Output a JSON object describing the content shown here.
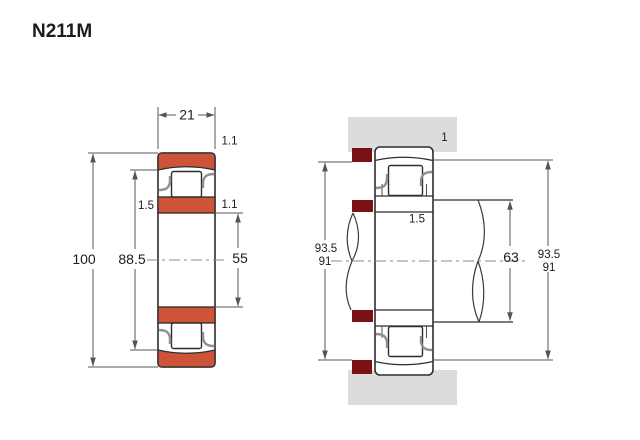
{
  "page": {
    "title": "N211M"
  },
  "colors": {
    "ring_fill": "#cd5438",
    "abutment_fill": "#7a1115",
    "housing_fill": "#dcdcdc"
  },
  "section_view": {
    "labels": {
      "width": "21",
      "outer_diameter": "100",
      "raceway_diameter": "88.5",
      "bore_diameter": "55",
      "od_chamfer": "1.1",
      "bore_chamfer": "1.1",
      "flange_chamfer": "1.5"
    }
  },
  "mounted_view": {
    "labels": {
      "housing_fillet": "1",
      "shaft_fillet": "1.5",
      "shaft_abutment_diameter": "63",
      "left_abutment_max": "93.5",
      "left_abutment_min": "91",
      "right_abutment_max": "93.5",
      "right_abutment_min": "91"
    }
  }
}
